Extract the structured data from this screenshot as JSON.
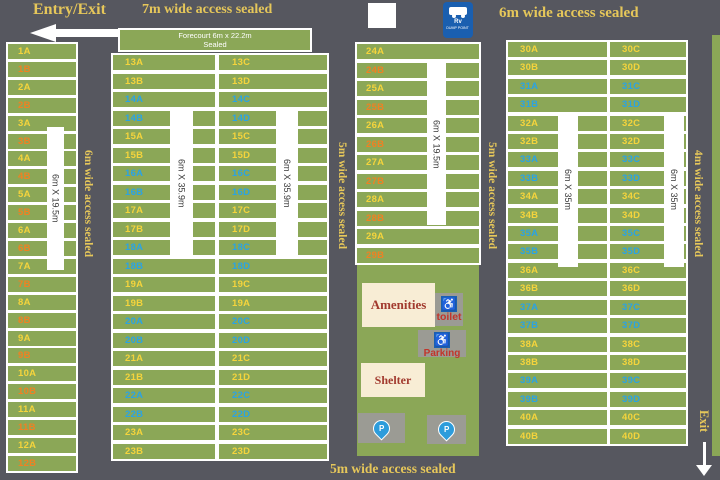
{
  "palette": {
    "road": "#56575F",
    "site_green": "#8BA757",
    "label_yellow": "#F5D43C",
    "label_orange": "#EF8123",
    "label_blue": "#2BA3E3",
    "road_label": "#E6C75A",
    "cream": "#F8EDD5",
    "dark_red": "#A23A2E",
    "red": "#C2352B",
    "gray_box": "#9B9B94",
    "icon_blue": "#1A5FB0",
    "pin_blue": "#2D9CDB"
  },
  "header": {
    "entry_exit": "Entry/Exit",
    "top_center_road": "7m wide access sealed",
    "top_right_road": "6m wide access sealed"
  },
  "roads": {
    "left_vertical": "6m wide access sealed",
    "mid_left_vertical": "5m wide access sealed",
    "mid_right_vertical": "5m wide access sealed",
    "right_vertical": "4m wide access sealed",
    "bottom": "5m wide access sealed",
    "exit": "Exit"
  },
  "forecourt": {
    "line1": "Forecourt 6m x 22.2m",
    "line2": "Sealed"
  },
  "strips": {
    "left": "6m X 19.5m",
    "block2_left": "6m X 35.9m",
    "block2_right": "6m X 35.9m",
    "middle": "6m X 19.5m",
    "right_left": "6m X 35m",
    "right_right": "6m X 35m"
  },
  "amenities": {
    "amenities_label": "Amenities",
    "toilet_label": "toilet",
    "parking_label": "Parking",
    "shelter_label": "Shelter",
    "rv_line1": "Rv",
    "rv_line2": "DUMP POINT"
  },
  "columns": {
    "left": [
      {
        "l": "1A",
        "c": "yellow"
      },
      {
        "l": "1B",
        "c": "orange"
      },
      {
        "l": "2A",
        "c": "yellow"
      },
      {
        "l": "2B",
        "c": "orange"
      },
      {
        "l": "3A",
        "c": "yellow"
      },
      {
        "l": "3B",
        "c": "orange"
      },
      {
        "l": "4A",
        "c": "yellow"
      },
      {
        "l": "4B",
        "c": "orange"
      },
      {
        "l": "5A",
        "c": "yellow"
      },
      {
        "l": "5B",
        "c": "orange"
      },
      {
        "l": "6A",
        "c": "yellow"
      },
      {
        "l": "6B",
        "c": "orange"
      },
      {
        "l": "7A",
        "c": "yellow"
      },
      {
        "l": "7B",
        "c": "orange"
      },
      {
        "l": "8A",
        "c": "yellow"
      },
      {
        "l": "8B",
        "c": "orange"
      },
      {
        "l": "9A",
        "c": "yellow"
      },
      {
        "l": "9B",
        "c": "orange"
      },
      {
        "l": "10A",
        "c": "yellow"
      },
      {
        "l": "10B",
        "c": "orange"
      },
      {
        "l": "11A",
        "c": "yellow"
      },
      {
        "l": "11B",
        "c": "orange"
      },
      {
        "l": "12A",
        "c": "yellow"
      },
      {
        "l": "12B",
        "c": "orange"
      }
    ],
    "block2_left": [
      {
        "l": "13A",
        "c": "yellow"
      },
      {
        "l": "13B",
        "c": "yellow"
      },
      {
        "l": "14A",
        "c": "blue"
      },
      {
        "l": "14B",
        "c": "blue"
      },
      {
        "l": "15A",
        "c": "yellow"
      },
      {
        "l": "15B",
        "c": "yellow"
      },
      {
        "l": "16A",
        "c": "blue"
      },
      {
        "l": "16B",
        "c": "blue"
      },
      {
        "l": "17A",
        "c": "yellow"
      },
      {
        "l": "17B",
        "c": "yellow"
      },
      {
        "l": "18A",
        "c": "blue"
      },
      {
        "l": "18B",
        "c": "blue"
      },
      {
        "l": "19A",
        "c": "yellow"
      },
      {
        "l": "19B",
        "c": "yellow"
      },
      {
        "l": "20A",
        "c": "blue"
      },
      {
        "l": "20B",
        "c": "blue"
      },
      {
        "l": "21A",
        "c": "yellow"
      },
      {
        "l": "21B",
        "c": "yellow"
      },
      {
        "l": "22A",
        "c": "blue"
      },
      {
        "l": "22B",
        "c": "blue"
      },
      {
        "l": "23A",
        "c": "yellow"
      },
      {
        "l": "23B",
        "c": "yellow"
      }
    ],
    "block2_right": [
      {
        "l": "13C",
        "c": "yellow"
      },
      {
        "l": "13D",
        "c": "yellow"
      },
      {
        "l": "14C",
        "c": "blue"
      },
      {
        "l": "14D",
        "c": "blue"
      },
      {
        "l": "15C",
        "c": "yellow"
      },
      {
        "l": "15D",
        "c": "yellow"
      },
      {
        "l": "16C",
        "c": "blue"
      },
      {
        "l": "16D",
        "c": "blue"
      },
      {
        "l": "17C",
        "c": "yellow"
      },
      {
        "l": "17D",
        "c": "yellow"
      },
      {
        "l": "18C",
        "c": "blue"
      },
      {
        "l": "18D",
        "c": "blue"
      },
      {
        "l": "19C",
        "c": "yellow"
      },
      {
        "l": "19A",
        "c": "yellow"
      },
      {
        "l": "20C",
        "c": "blue"
      },
      {
        "l": "20D",
        "c": "blue"
      },
      {
        "l": "21C",
        "c": "yellow"
      },
      {
        "l": "21D",
        "c": "yellow"
      },
      {
        "l": "22C",
        "c": "blue"
      },
      {
        "l": "22D",
        "c": "blue"
      },
      {
        "l": "23C",
        "c": "yellow"
      },
      {
        "l": "23D",
        "c": "yellow"
      }
    ],
    "middle": [
      {
        "l": "24A",
        "c": "yellow"
      },
      {
        "l": "24B",
        "c": "orange"
      },
      {
        "l": "25A",
        "c": "yellow"
      },
      {
        "l": "25B",
        "c": "orange"
      },
      {
        "l": "26A",
        "c": "yellow"
      },
      {
        "l": "26B",
        "c": "orange"
      },
      {
        "l": "27A",
        "c": "yellow"
      },
      {
        "l": "27B",
        "c": "orange"
      },
      {
        "l": "28A",
        "c": "yellow"
      },
      {
        "l": "28B",
        "c": "orange"
      },
      {
        "l": "29A",
        "c": "yellow"
      },
      {
        "l": "29B",
        "c": "orange"
      }
    ],
    "right_left": [
      {
        "l": "30A",
        "c": "yellow"
      },
      {
        "l": "30B",
        "c": "yellow"
      },
      {
        "l": "31A",
        "c": "blue"
      },
      {
        "l": "31B",
        "c": "blue"
      },
      {
        "l": "32A",
        "c": "yellow"
      },
      {
        "l": "32B",
        "c": "yellow"
      },
      {
        "l": "33A",
        "c": "blue"
      },
      {
        "l": "33B",
        "c": "blue"
      },
      {
        "l": "34A",
        "c": "yellow"
      },
      {
        "l": "34B",
        "c": "yellow"
      },
      {
        "l": "35A",
        "c": "blue"
      },
      {
        "l": "35B",
        "c": "blue"
      },
      {
        "l": "36A",
        "c": "yellow"
      },
      {
        "l": "36B",
        "c": "yellow"
      },
      {
        "l": "37A",
        "c": "blue"
      },
      {
        "l": "37B",
        "c": "blue"
      },
      {
        "l": "38A",
        "c": "yellow"
      },
      {
        "l": "38B",
        "c": "yellow"
      },
      {
        "l": "39A",
        "c": "blue"
      },
      {
        "l": "39B",
        "c": "blue"
      },
      {
        "l": "40A",
        "c": "yellow"
      },
      {
        "l": "40B",
        "c": "yellow"
      }
    ],
    "right_right": [
      {
        "l": "30C",
        "c": "yellow"
      },
      {
        "l": "30D",
        "c": "yellow"
      },
      {
        "l": "31C",
        "c": "blue"
      },
      {
        "l": "31D",
        "c": "blue"
      },
      {
        "l": "32C",
        "c": "yellow"
      },
      {
        "l": "32D",
        "c": "yellow"
      },
      {
        "l": "33C",
        "c": "blue"
      },
      {
        "l": "33D",
        "c": "blue"
      },
      {
        "l": "34C",
        "c": "yellow"
      },
      {
        "l": "34D",
        "c": "yellow"
      },
      {
        "l": "35C",
        "c": "blue"
      },
      {
        "l": "35D",
        "c": "blue"
      },
      {
        "l": "36C",
        "c": "yellow"
      },
      {
        "l": "36D",
        "c": "yellow"
      },
      {
        "l": "37C",
        "c": "blue"
      },
      {
        "l": "37D",
        "c": "blue"
      },
      {
        "l": "38C",
        "c": "yellow"
      },
      {
        "l": "38D",
        "c": "yellow"
      },
      {
        "l": "39C",
        "c": "blue"
      },
      {
        "l": "39D",
        "c": "blue"
      },
      {
        "l": "40C",
        "c": "yellow"
      },
      {
        "l": "40D",
        "c": "yellow"
      }
    ]
  }
}
